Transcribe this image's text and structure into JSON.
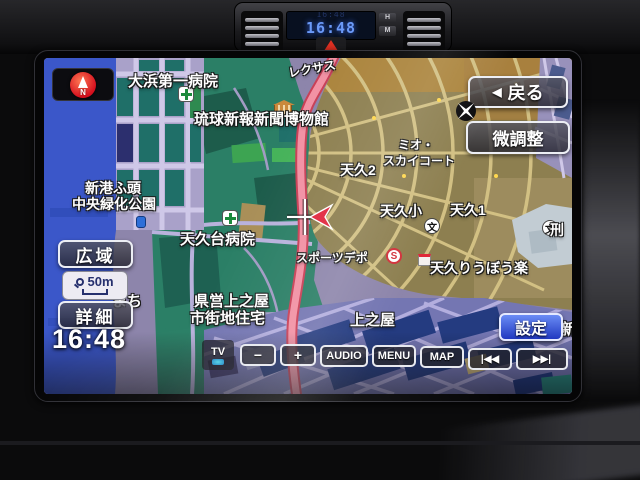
{
  "dashboard": {
    "clock_time": "16:48",
    "clock_reflection": "16:48",
    "hour_button": "H",
    "minute_button": "M"
  },
  "screen": {
    "compass_n": "N",
    "back_arrow": "◀",
    "back_label": "戻る",
    "fine_adjust_label": "微調整",
    "wide_label": "広域",
    "detail_label": "詳細",
    "scale_value": "50m",
    "time": "16:48",
    "settings_label": "設定",
    "toolbar": {
      "tv": "TV",
      "minus": "−",
      "plus": "+",
      "audio": "AUDIO",
      "menu": "MENU",
      "map": "MAP",
      "prev": "|◀◀",
      "next": "▶▶|"
    }
  },
  "map": {
    "school_glyph": "文",
    "store_glyph": "S",
    "labels": [
      {
        "text": "大浜第一病院"
      },
      {
        "text": "レクサス"
      },
      {
        "text": "琉球新報新聞博物館"
      },
      {
        "text": "ミオ・"
      },
      {
        "text": "スカイコート"
      },
      {
        "text": "天久2"
      },
      {
        "text": "新港ふ頭"
      },
      {
        "text": "中央緑化公園"
      },
      {
        "text": "天久台病院"
      },
      {
        "text": "天久小"
      },
      {
        "text": "天久1"
      },
      {
        "text": "まち"
      },
      {
        "text": "スポーツデポ"
      },
      {
        "text": "天久りうぼう楽"
      },
      {
        "text": "県営上之屋"
      },
      {
        "text": "市街地住宅"
      },
      {
        "text": "上之屋"
      },
      {
        "text": "新"
      },
      {
        "text": "刑"
      }
    ],
    "colors": {
      "water": "#3b57c9",
      "park": "#2b7f66",
      "urban": "#8d7f50",
      "major_road": "#f291a4",
      "night_blocks": "#243b80"
    }
  }
}
